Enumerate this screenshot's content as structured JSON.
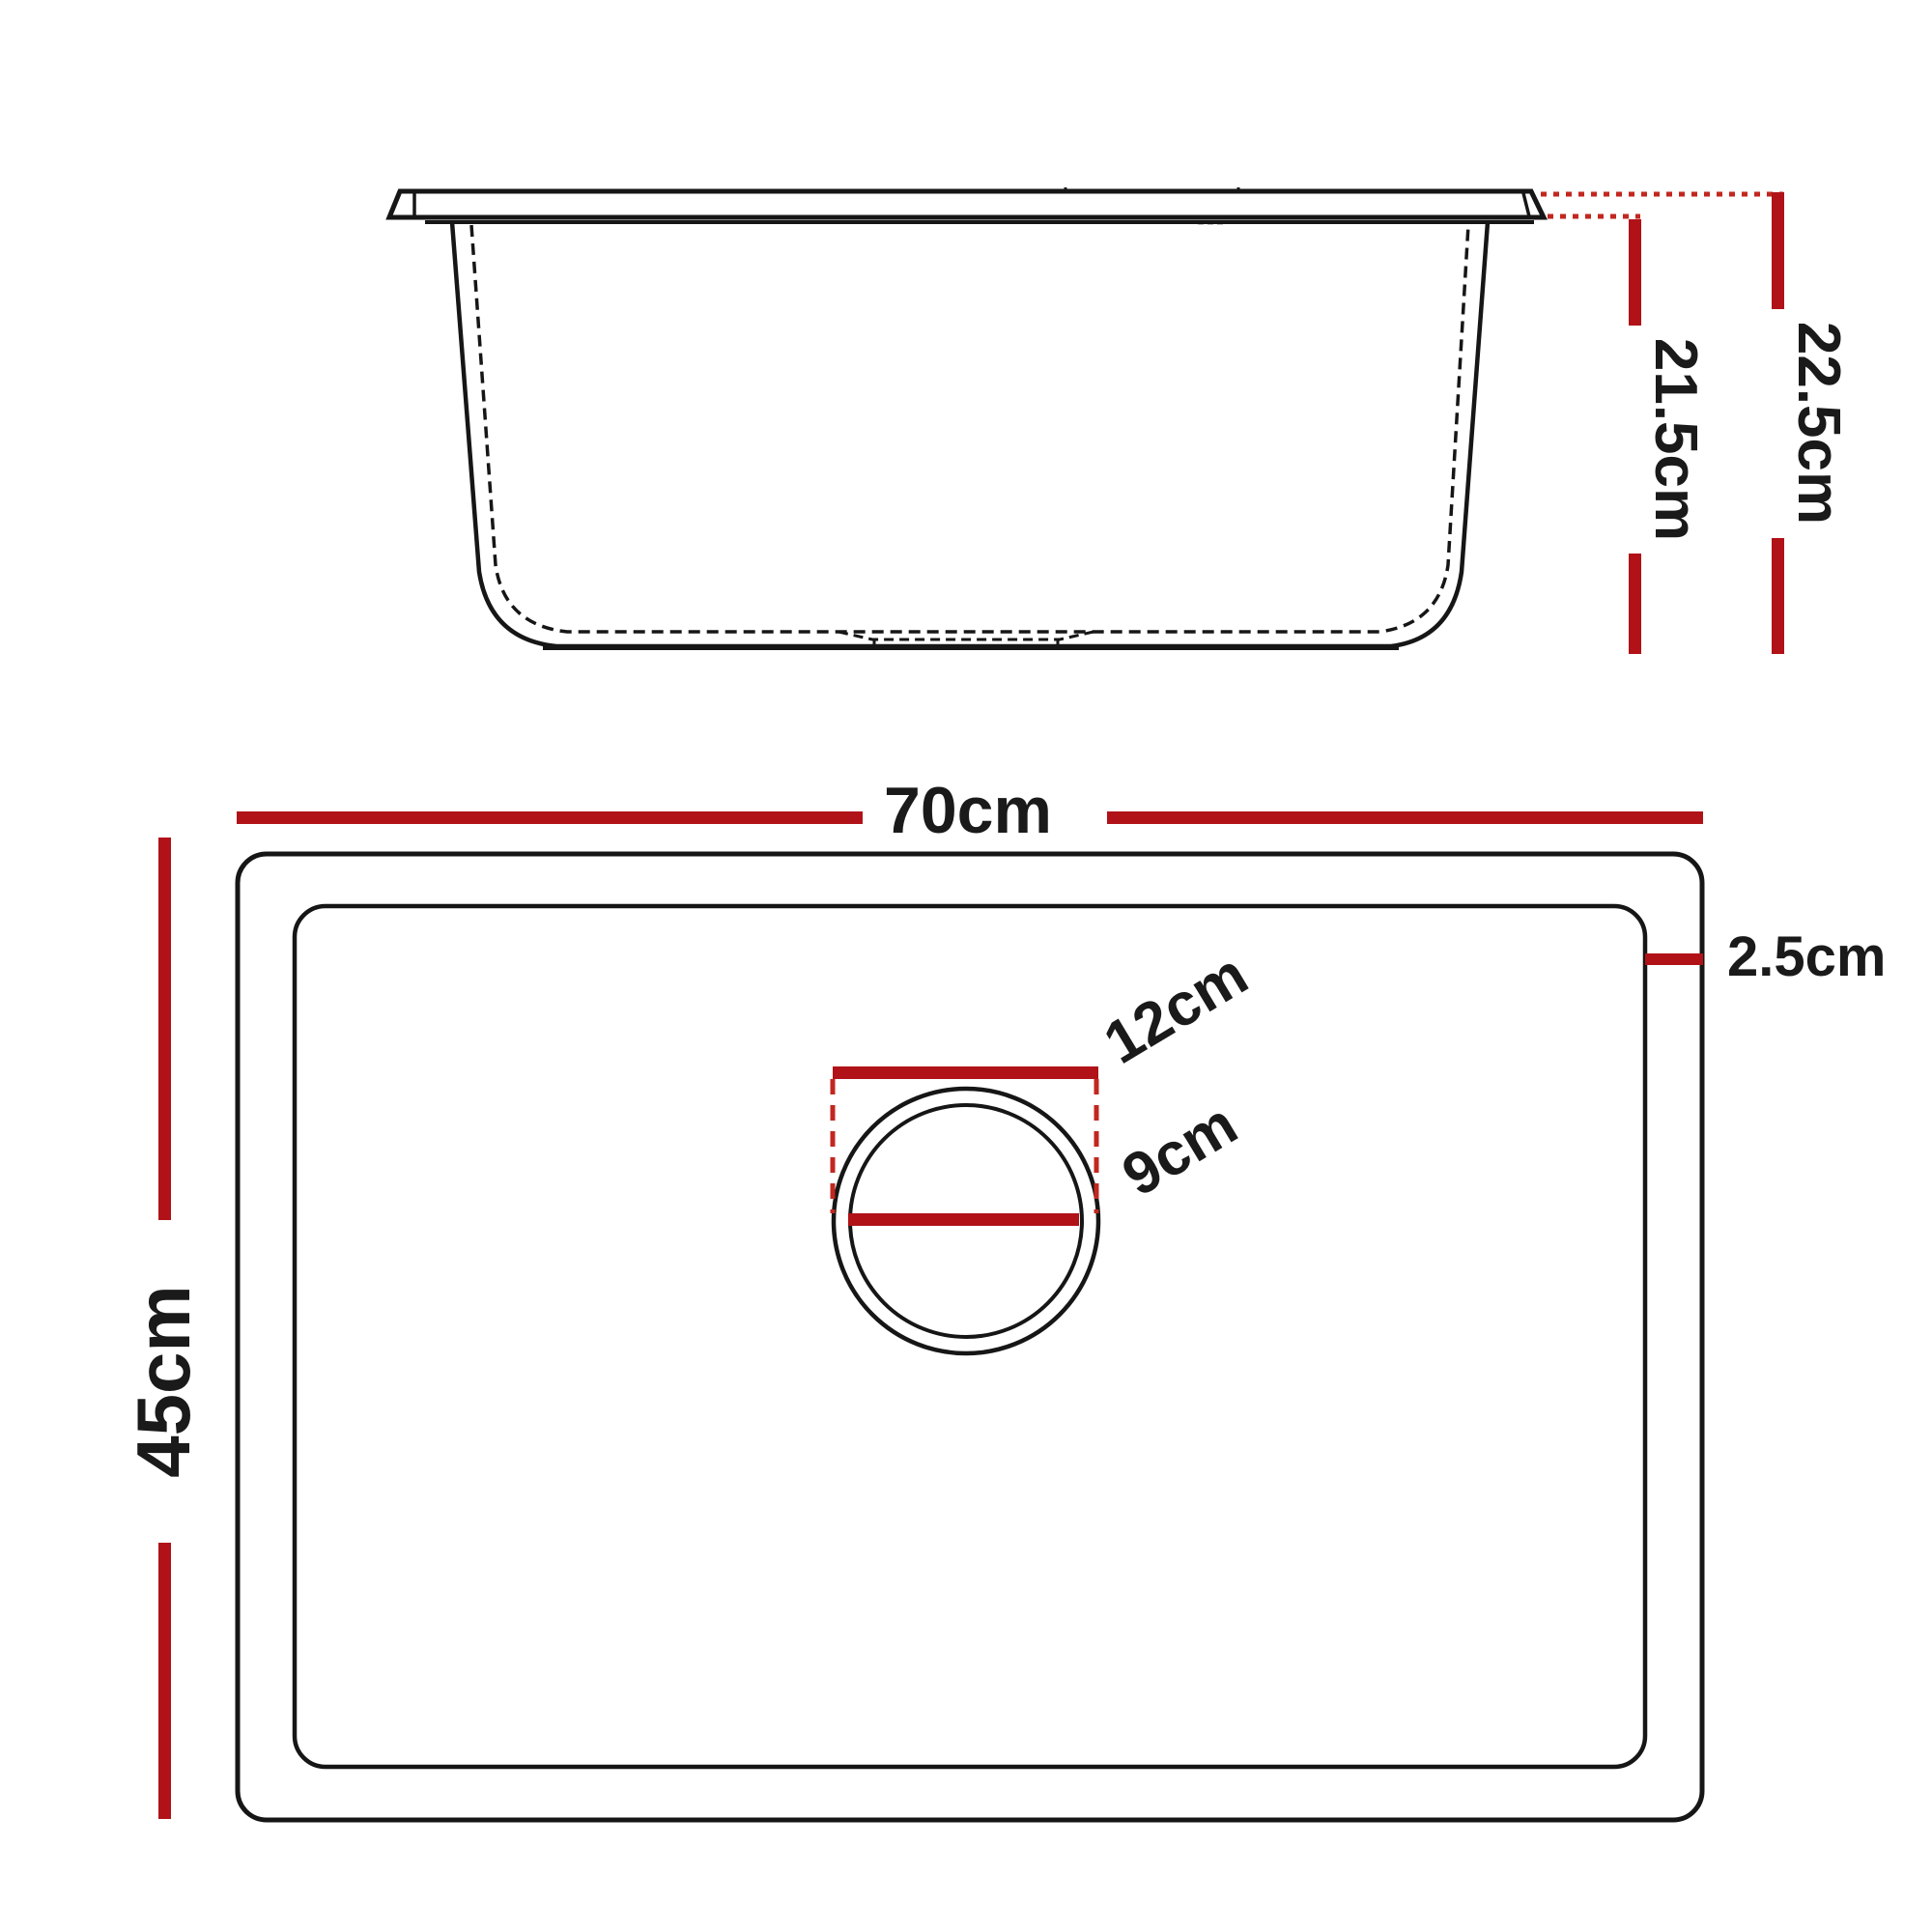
{
  "colors": {
    "dimension_red": "#b01218",
    "leader_red": "#c2271f",
    "drawing_black": "#161616",
    "background": "#ffffff"
  },
  "side_view": {
    "dim_inner_height": "21.5cm",
    "dim_overall_height": "22.5cm"
  },
  "plan_view": {
    "dim_overall_width": "70cm",
    "dim_overall_depth": "45cm",
    "dim_rim_width": "2.5cm",
    "dim_drain_recess": "12cm",
    "dim_drain_hole": "9cm"
  }
}
